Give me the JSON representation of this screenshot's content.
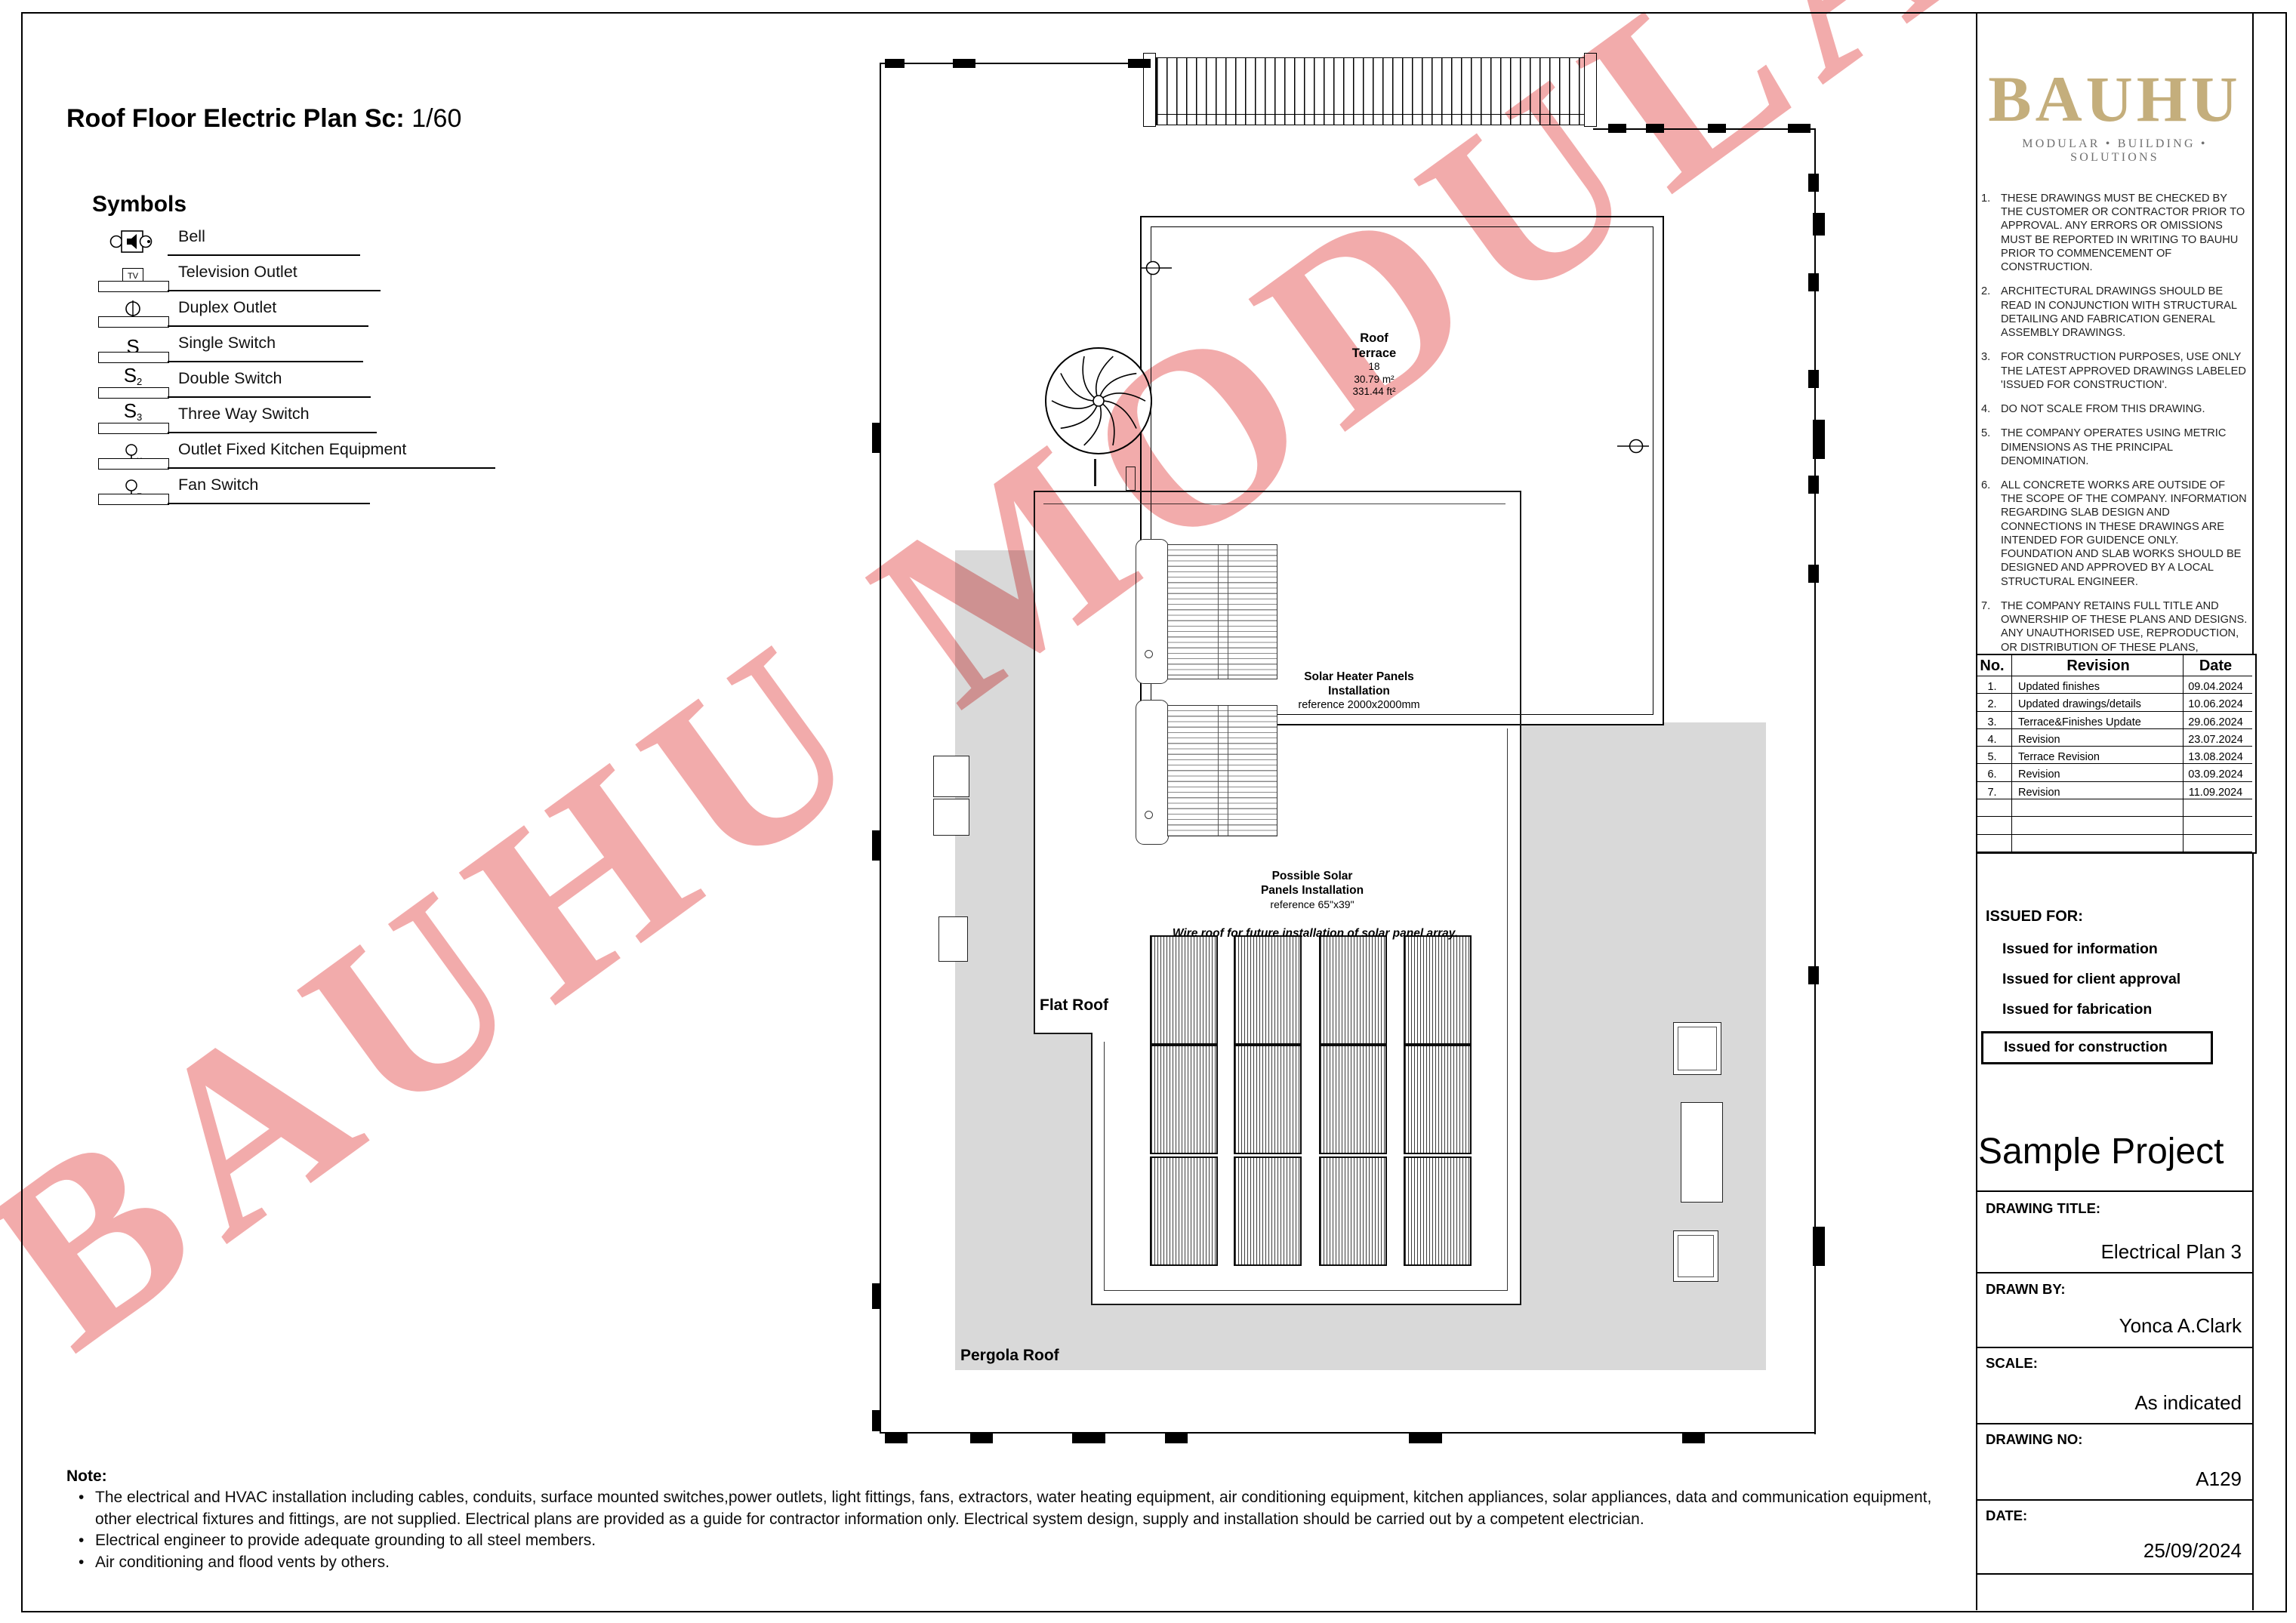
{
  "sheet": {
    "title": "Roof Floor Electric Plan Sc:",
    "scale_value": "1/60"
  },
  "legend": {
    "heading": "Symbols",
    "items": [
      {
        "icon": "bell-icon",
        "label": "Bell"
      },
      {
        "icon": "tv-outlet-icon",
        "label": "Television Outlet"
      },
      {
        "icon": "duplex-outlet-icon",
        "label": "Duplex Outlet"
      },
      {
        "icon": "single-switch-icon",
        "label": "Single Switch"
      },
      {
        "icon": "double-switch-icon",
        "label": "Double Switch"
      },
      {
        "icon": "three-way-switch-icon",
        "label": "Three Way Switch"
      },
      {
        "icon": "kitchen-outlet-icon",
        "label": "Outlet Fixed Kitchen Equipment"
      },
      {
        "icon": "fan-switch-icon",
        "label": "Fan Switch"
      }
    ]
  },
  "plan": {
    "roof_terrace": {
      "line1": "Roof",
      "line2": "Terrace",
      "number": "18",
      "area_m2": "30.79 m²",
      "area_ft2": "331.44 ft²"
    },
    "solar_heater": {
      "l1": "Solar Heater Panels",
      "l2": "Installation",
      "l3": "reference 2000x2000mm"
    },
    "possible_solar": {
      "l1": "Possible Solar",
      "l2": "Panels Installation",
      "l3": "reference 65\"x39\""
    },
    "wire_note": "Wire roof for future installation of solar panel array.",
    "flat_roof": "Flat Roof",
    "pergola_roof": "Pergola Roof"
  },
  "watermark": "BAUHU MODULAR",
  "sidebar": {
    "logo": {
      "name": "BAUHU",
      "tagline": "MODULAR  •  BUILDING  •  SOLUTIONS"
    },
    "notes": [
      {
        "no": "1.",
        "text": "THESE DRAWINGS MUST BE CHECKED BY THE CUSTOMER OR CONTRACTOR PRIOR TO APPROVAL. ANY ERRORS OR OMISSIONS MUST BE REPORTED IN WRITING TO BAUHU PRIOR TO COMMENCEMENT OF CONSTRUCTION."
      },
      {
        "no": "2.",
        "text": "ARCHITECTURAL DRAWINGS SHOULD BE READ IN CONJUNCTION WITH STRUCTURAL DETAILING AND FABRICATION GENERAL ASSEMBLY DRAWINGS."
      },
      {
        "no": "3.",
        "text": "FOR CONSTRUCTION PURPOSES, USE ONLY THE LATEST APPROVED DRAWINGS LABELED 'ISSUED FOR CONSTRUCTION'."
      },
      {
        "no": "4.",
        "text": "DO NOT SCALE FROM THIS DRAWING."
      },
      {
        "no": "5.",
        "text": "THE COMPANY OPERATES USING METRIC DIMENSIONS AS THE PRINCIPAL DENOMINATION."
      },
      {
        "no": "6.",
        "text": "ALL CONCRETE WORKS ARE OUTSIDE OF THE SCOPE OF THE COMPANY. INFORMATION REGARDING SLAB DESIGN AND CONNECTIONS IN THESE DRAWINGS ARE INTENDED FOR GUIDENCE ONLY. FOUNDATION AND SLAB WORKS SHOULD BE DESIGNED AND APPROVED BY A LOCAL STRUCTURAL ENGINEER."
      },
      {
        "no": "7.",
        "text": "THE COMPANY RETAINS FULL TITLE AND OWNERSHIP OF THESE PLANS AND DESIGNS. ANY UNAUTHORISED USE, REPRODUCTION, OR DISTRIBUTION OF THESE PLANS, WHETHER IN WHOLE OR PART, IS EXPRESSLY PROHIBITED WITHOUT PRIOR WRITTEN CONSENT."
      }
    ],
    "revision_table": {
      "headers": [
        "No.",
        "Revision",
        "Date"
      ],
      "rows": [
        [
          "1.",
          "Updated finishes",
          "09.04.2024"
        ],
        [
          "2.",
          "Updated drawings/details",
          "10.06.2024"
        ],
        [
          "3.",
          "Terrace&Finishes Update",
          "29.06.2024"
        ],
        [
          "4.",
          "Revision",
          "23.07.2024"
        ],
        [
          "5.",
          "Terrace Revision",
          "13.08.2024"
        ],
        [
          "6.",
          "Revision",
          "03.09.2024"
        ],
        [
          "7.",
          "Revision",
          "11.09.2024"
        ]
      ],
      "empty_rows": 3
    },
    "issued": {
      "heading": "ISSUED FOR:",
      "items": [
        "Issued for information",
        "Issued for client approval",
        "Issued for fabrication",
        "Issued for construction"
      ],
      "selected": "Issued for construction"
    },
    "project_name": "Sample Project",
    "title_block": [
      {
        "label": "DRAWING TITLE:",
        "value": "Electrical Plan 3"
      },
      {
        "label": "DRAWN BY:",
        "value": "Yonca A.Clark"
      },
      {
        "label": "SCALE:",
        "value": "As indicated"
      },
      {
        "label": "DRAWING NO:",
        "value": "A129"
      },
      {
        "label": "DATE:",
        "value": "25/09/2024"
      }
    ]
  },
  "footer_note": {
    "heading": "Note:",
    "bullets": [
      "The electrical and HVAC installation including cables, conduits, surface mounted switches,power outlets, light fittings, fans, extractors, water heating equipment, air conditioning equipment, kitchen appliances, solar appliances, data and communication equipment, other electrical fixtures and fittings, are not supplied. Electrical plans are provided as a guide for contractor information only. Electrical system design, supply and installation should be carried out by a competent electrician.",
      "Electrical engineer to provide adequate grounding to all steel members.",
      "Air conditioning and flood vents by others."
    ]
  },
  "colors": {
    "roof_gray": "#d9d9d9",
    "logo_gold": "#c4ae7c",
    "watermark_pink": "#f2abab",
    "line_black": "#000000"
  }
}
